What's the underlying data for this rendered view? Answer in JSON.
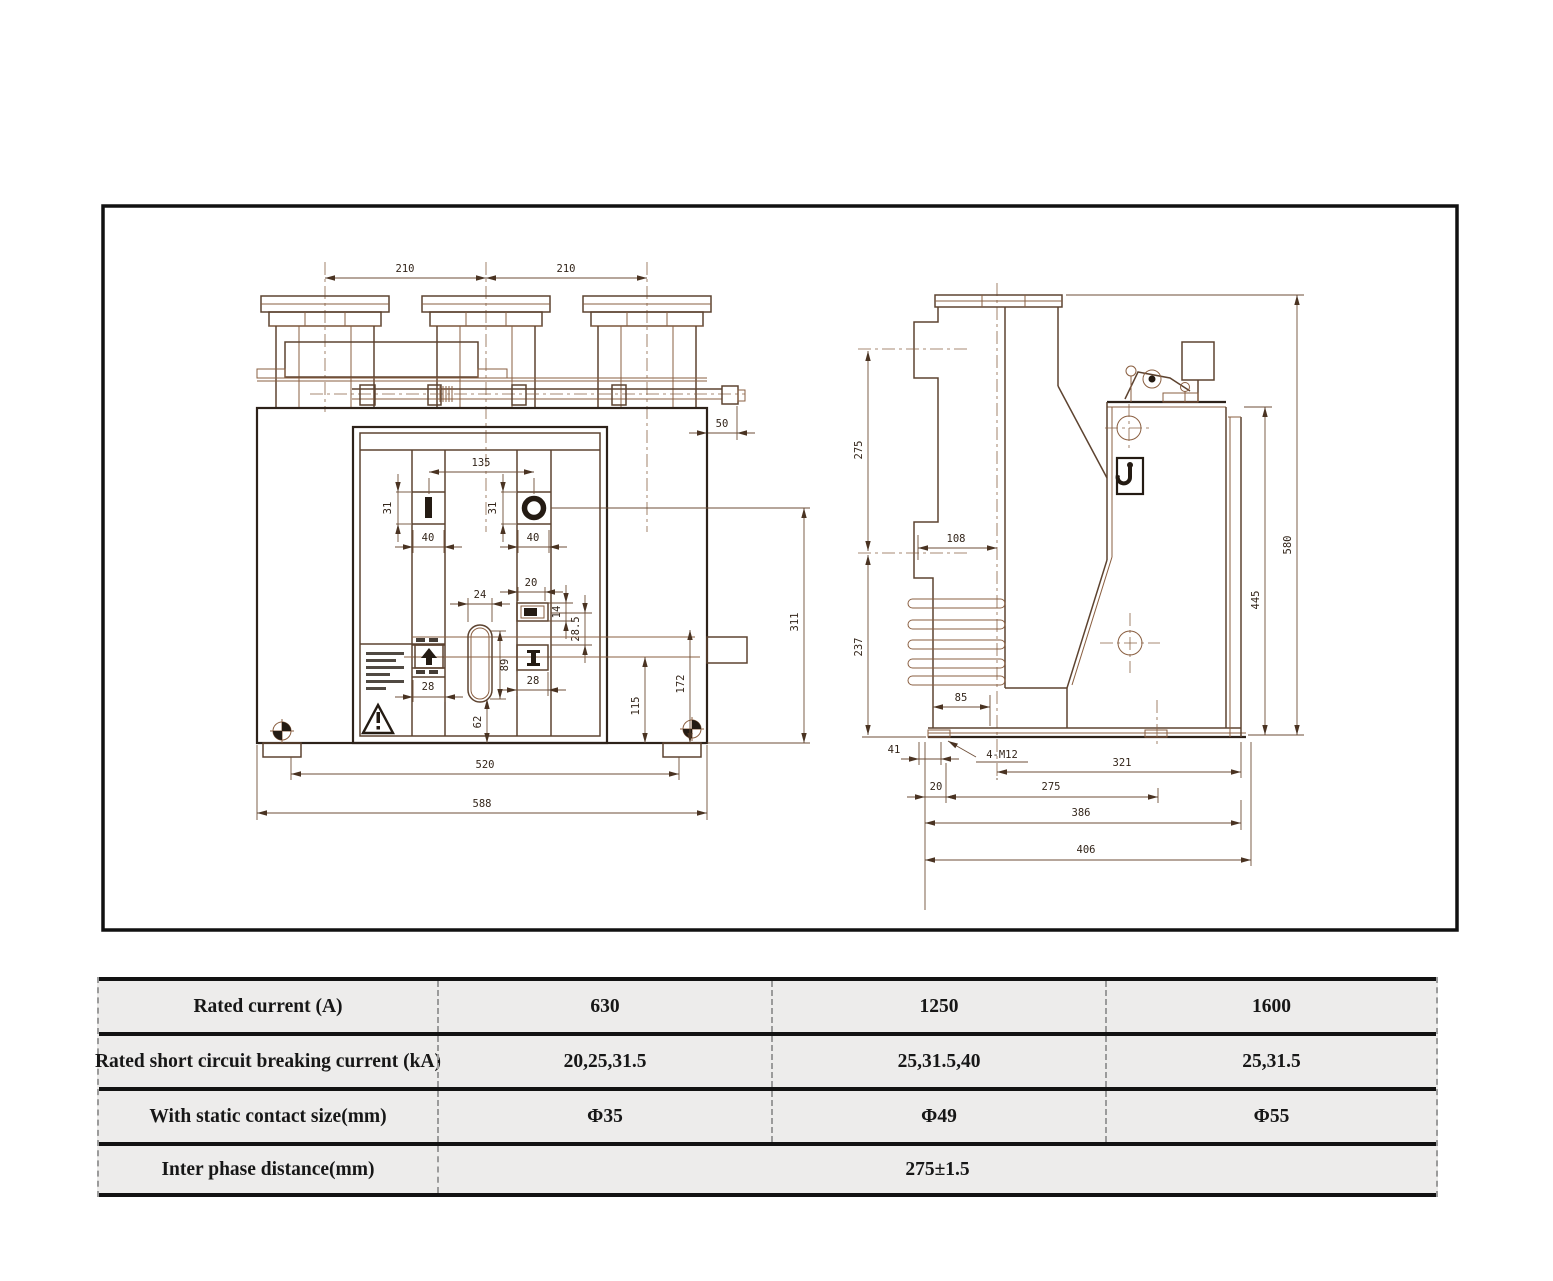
{
  "drawing": {
    "frame_color": "#111111",
    "line_color": "#5d4330",
    "front_view": {
      "pitch_a": "210",
      "pitch_b": "210",
      "shaft_ext": "50",
      "switch_span": "135",
      "sym_h_a": "31",
      "sym_h_b": "31",
      "sym_w_a": "40",
      "sym_w_b": "40",
      "slot_top_w": "20",
      "oval_w": "24",
      "slot_h": "14",
      "slot_gap": "28.5",
      "oval_h": "89",
      "port_w": "28",
      "col_w": "28",
      "oval_base": "62",
      "h_lower": "115",
      "h_mid": "172",
      "h_upper": "311",
      "base_inner": "520",
      "base_outer": "588"
    },
    "side_view": {
      "arm_upper": "275",
      "arm_lower": "237",
      "pole_offset": "108",
      "base_step": "85",
      "foot_offset": "41",
      "bolt_spec": "4-M12",
      "edge_offset": "20",
      "hole_pitch": "275",
      "depth_inner": "321",
      "depth_mid": "386",
      "depth_outer": "406",
      "h_tank": "445",
      "h_total": "580"
    },
    "icons": {
      "close_symbol": "I-bar",
      "open_symbol": "O-ring",
      "hoist_hook": "hook",
      "warning": "exclamation-triangle",
      "ground": "earth-mark",
      "lift_point": "crosshair-target",
      "push_direction": "up-arrow"
    }
  },
  "table": {
    "bg": "#edeceb",
    "rows": [
      {
        "label": "Rated current (A)",
        "values": [
          "630",
          "1250",
          "1600"
        ]
      },
      {
        "label": "Rated short circuit breaking current (kA)",
        "values": [
          "20,25,31.5",
          "25,31.5,40",
          "25,31.5"
        ]
      },
      {
        "label": "With static contact size(mm)",
        "values": [
          "Φ35",
          "Φ49",
          "Φ55"
        ]
      },
      {
        "label": "Inter phase distance(mm)",
        "merged": "275±1.5"
      }
    ]
  }
}
